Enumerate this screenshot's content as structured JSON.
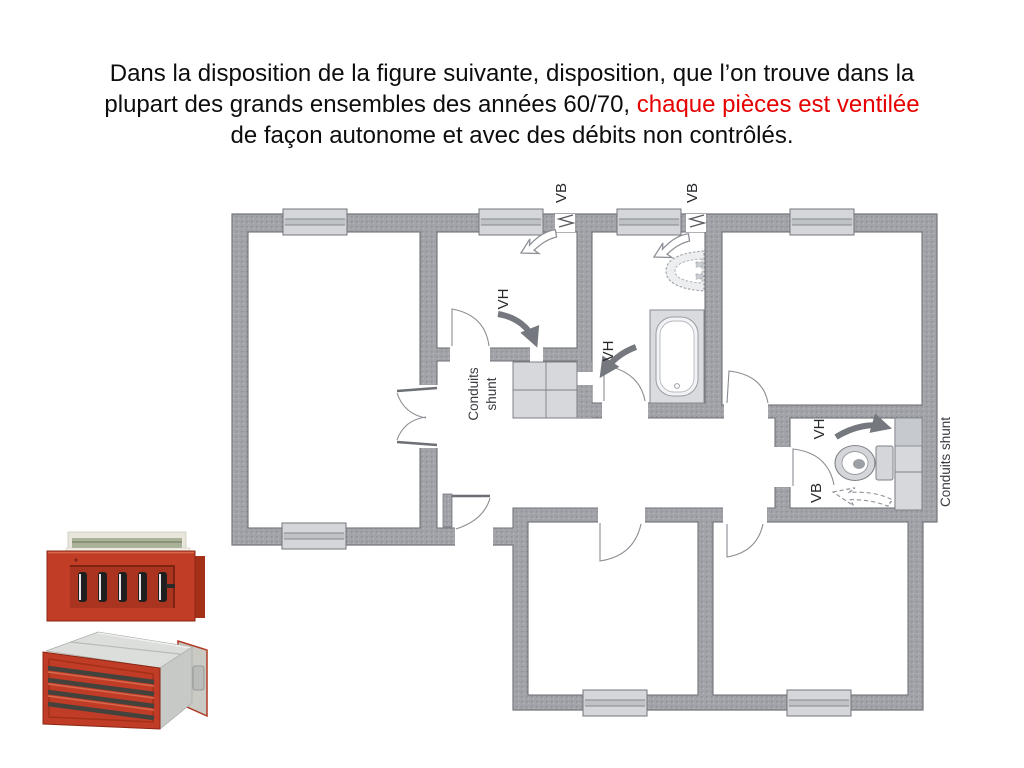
{
  "title": {
    "line1": "Dans la disposition de la figure suivante, disposition, que l’on trouve dans la",
    "line2_black": "plupart des grands ensembles des années 60/70, ",
    "line2_red": "chaque pièces est ventilée",
    "line3": "de façon autonome et avec des débits non contrôlés."
  },
  "floor_plan": {
    "labels": {
      "vb_left": "VB",
      "vb_right": "VB",
      "vh_kitchen": "VH",
      "vh_bathroom": "VH",
      "vh_wc": "VH",
      "vb_wc": "VB",
      "shunt_kitchen_line1": "Conduits",
      "shunt_kitchen_line2": "shunt",
      "shunt_wc": "Conduits shunt"
    }
  },
  "colors": {
    "text_red": "#e60000",
    "wall_gray": "#a0a2a7",
    "window_gray": "#d4d6da",
    "arrow_dark": "#75787e",
    "grille_red": "#c23d26"
  }
}
